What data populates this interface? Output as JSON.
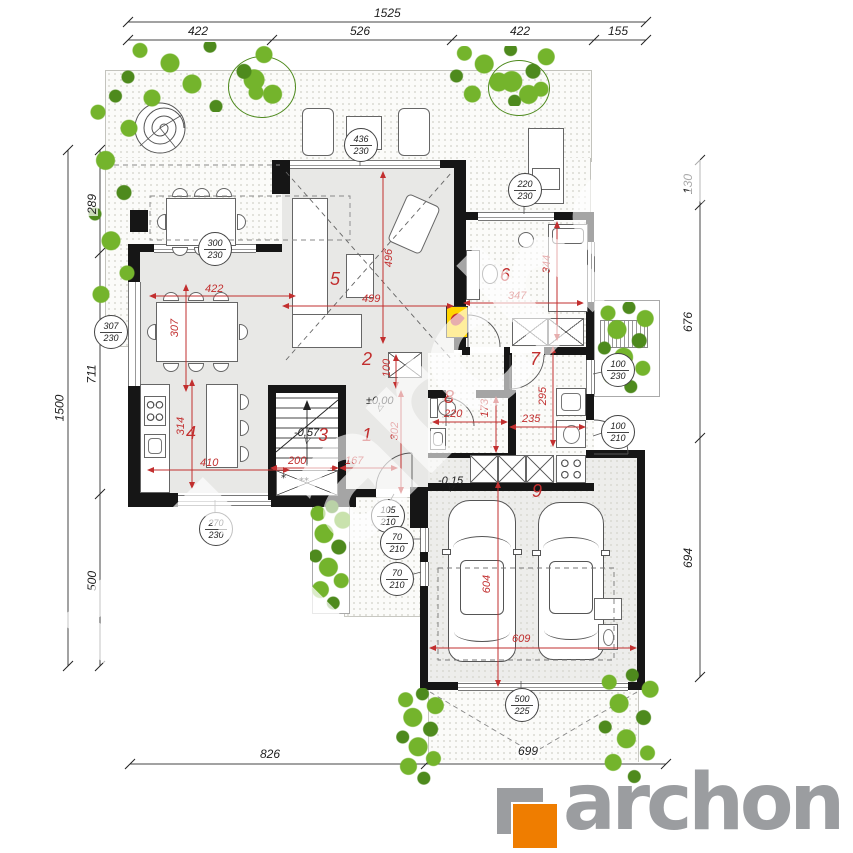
{
  "colors": {
    "red": "#c22f2f",
    "wall": "#161616",
    "green": "#74b42c",
    "green_dark": "#4e8a1d",
    "logo_gray": "#9b9da0",
    "logo_orange": "#ef7d00",
    "fire_yellow": "#ffd400"
  },
  "brand": {
    "logo_text": "archon",
    "watermark_text": "archon"
  },
  "dims": {
    "top_total": "1525",
    "top": [
      "422",
      "526",
      "422",
      "155"
    ],
    "left_total": "1500",
    "left": [
      "289",
      "711",
      "500"
    ],
    "right": [
      "130",
      "676",
      "694"
    ],
    "bottom": [
      "826",
      "699"
    ]
  },
  "rooms": [
    {
      "no": "1",
      "w": "167",
      "h": "302",
      "level": "±0,00"
    },
    {
      "no": "2",
      "w": "100"
    },
    {
      "no": "3",
      "w": "200",
      "level": "-0,57"
    },
    {
      "no": "4",
      "w": "410",
      "h": "314"
    },
    {
      "no": "5",
      "w": "499",
      "h": "496"
    },
    {
      "no": "6",
      "w": "347",
      "h": "344"
    },
    {
      "no": "7",
      "w": "235",
      "h": "295"
    },
    {
      "no": "8",
      "w": "220",
      "h": "173"
    },
    {
      "no": "9",
      "w": "609",
      "h": "604",
      "level": "-0,15"
    }
  ],
  "open_dims": {
    "dining_w": "422",
    "dining_h": "307"
  },
  "openings": [
    {
      "name": "living-window",
      "w": "436",
      "h": "230"
    },
    {
      "name": "dining-window-north",
      "w": "300",
      "h": "230"
    },
    {
      "name": "dining-window-west",
      "w": "307",
      "h": "230"
    },
    {
      "name": "bedroom-window",
      "w": "220",
      "h": "230"
    },
    {
      "name": "utility-window",
      "w": "100",
      "h": "230"
    },
    {
      "name": "side-door",
      "w": "100",
      "h": "210"
    },
    {
      "name": "kitchen-window",
      "w": "270",
      "h": "230"
    },
    {
      "name": "entrance-door",
      "w": "105",
      "h": "210"
    },
    {
      "name": "entry-glazing-1",
      "w": "70",
      "h": "210"
    },
    {
      "name": "entry-glazing-2",
      "w": "70",
      "h": "210"
    },
    {
      "name": "garage-door",
      "w": "500",
      "h": "225"
    }
  ],
  "stairs": {
    "mark1": "*",
    "mark2": "**"
  }
}
